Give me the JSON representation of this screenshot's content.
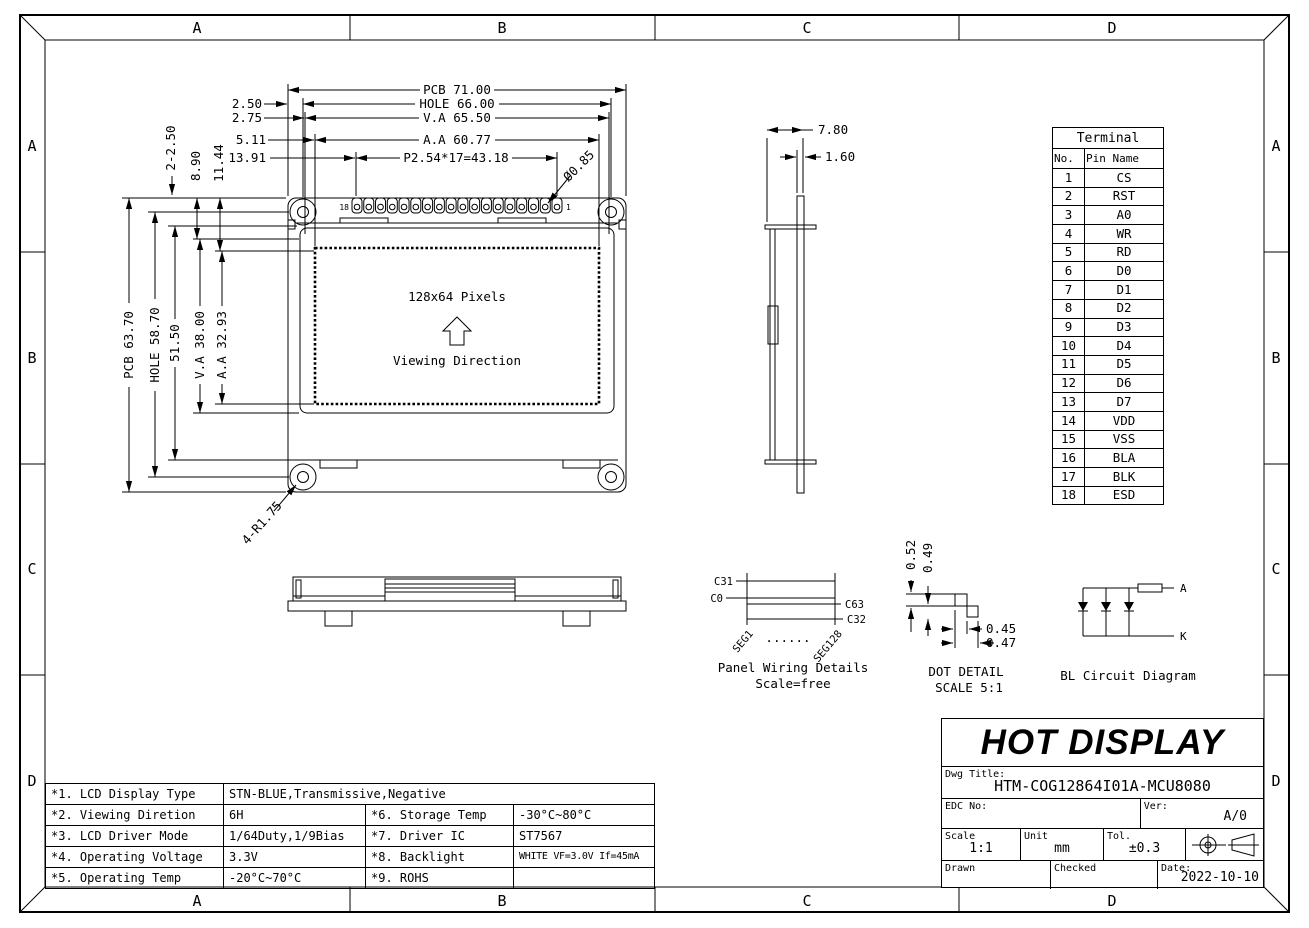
{
  "frame": {
    "zones": [
      "A",
      "B",
      "C",
      "D"
    ]
  },
  "front_view": {
    "screen_label": "128x64 Pixels",
    "viewing_label": "Viewing Direction",
    "pin_last": "18",
    "pin_first": "1",
    "dims": {
      "pcb_width": "PCB 71.00",
      "hole_width": "HOLE 66.00",
      "va_width": "V.A 65.50",
      "aa_width": "A.A 60.77",
      "pin_pitch": "P2.54*17=43.18",
      "offset_hole": "2.50",
      "offset_va": "2.75",
      "offset_aa": "5.11",
      "offset_pitch": "13.91",
      "pin_hole_dia": "Ø0.85",
      "pcb_height": "PCB 63.70",
      "hole_height": "HOLE 58.70",
      "conn_height": "51.50",
      "va_height": "V.A 38.00",
      "aa_height": "A.A 32.93",
      "mount_hole": "2-2.50",
      "offset_va_v": "8.90",
      "offset_aa_v": "11.44",
      "corner_radius": "4-R1.75"
    }
  },
  "side_view": {
    "total_thickness": "7.80",
    "pcb_thickness": "1.60"
  },
  "terminal": {
    "title": "Terminal",
    "col_no": "No.",
    "col_pin": "Pin Name",
    "rows": [
      [
        "1",
        "CS"
      ],
      [
        "2",
        "RST"
      ],
      [
        "3",
        "A0"
      ],
      [
        "4",
        "WR"
      ],
      [
        "5",
        "RD"
      ],
      [
        "6",
        "D0"
      ],
      [
        "7",
        "D1"
      ],
      [
        "8",
        "D2"
      ],
      [
        "9",
        "D3"
      ],
      [
        "10",
        "D4"
      ],
      [
        "11",
        "D5"
      ],
      [
        "12",
        "D6"
      ],
      [
        "13",
        "D7"
      ],
      [
        "14",
        "VDD"
      ],
      [
        "15",
        "VSS"
      ],
      [
        "16",
        "BLA"
      ],
      [
        "17",
        "BLK"
      ],
      [
        "18",
        "ESD"
      ]
    ]
  },
  "panel_wiring": {
    "com_top_left": "C31",
    "com_bottom_left": "C0",
    "com_top_right": "C63",
    "com_bottom_right": "C32",
    "seg_first": "SEG1",
    "seg_last": "SEG128",
    "dots": "......",
    "title": "Panel Wiring Details",
    "scale": "Scale=free"
  },
  "dot_detail": {
    "dim_v1": "0.52",
    "dim_v2": "0.49",
    "dim_h1": "0.45",
    "dim_h2": "0.47",
    "title": "DOT DETAIL",
    "scale": "SCALE 5:1"
  },
  "bl_circuit": {
    "anode_label": "A",
    "cathode_label": "K",
    "title": "BL Circuit Diagram"
  },
  "spec": {
    "rows": [
      {
        "item": "*1. LCD Display Type",
        "value": "STN-BLUE,Transmissive,Negative"
      },
      {
        "item": "*2. Viewing Diretion",
        "value": "6H",
        "item2": "*6. Storage Temp",
        "value2": "-30°C~80°C"
      },
      {
        "item": "*3. LCD Driver Mode",
        "value": "1/64Duty,1/9Bias",
        "item2": "*7. Driver IC",
        "value2": "ST7567"
      },
      {
        "item": "*4. Operating Voltage",
        "value": "3.3V",
        "item2": "*8. Backlight",
        "value2": "WHITE VF=3.0V If=45mA"
      },
      {
        "item": "*5. Operating Temp",
        "value": "-20°C~70°C",
        "item2": "*9. ROHS",
        "value2": ""
      }
    ]
  },
  "title_block": {
    "company": "HOT DISPLAY",
    "dwg_title_label": "Dwg Title:",
    "dwg_title": "HTM-COG12864I01A-MCU8080",
    "edc_label": "EDC No:",
    "ver_label": "Ver:",
    "version": "A/0",
    "scale_label": "Scale",
    "scale": "1:1",
    "unit_label": "Unit",
    "unit": "mm",
    "tol_label": "Tol.",
    "tolerance": "±0.3",
    "drawn_label": "Drawn",
    "checked_label": "Checked",
    "date_label": "Date:",
    "date": "2022-10-10"
  }
}
